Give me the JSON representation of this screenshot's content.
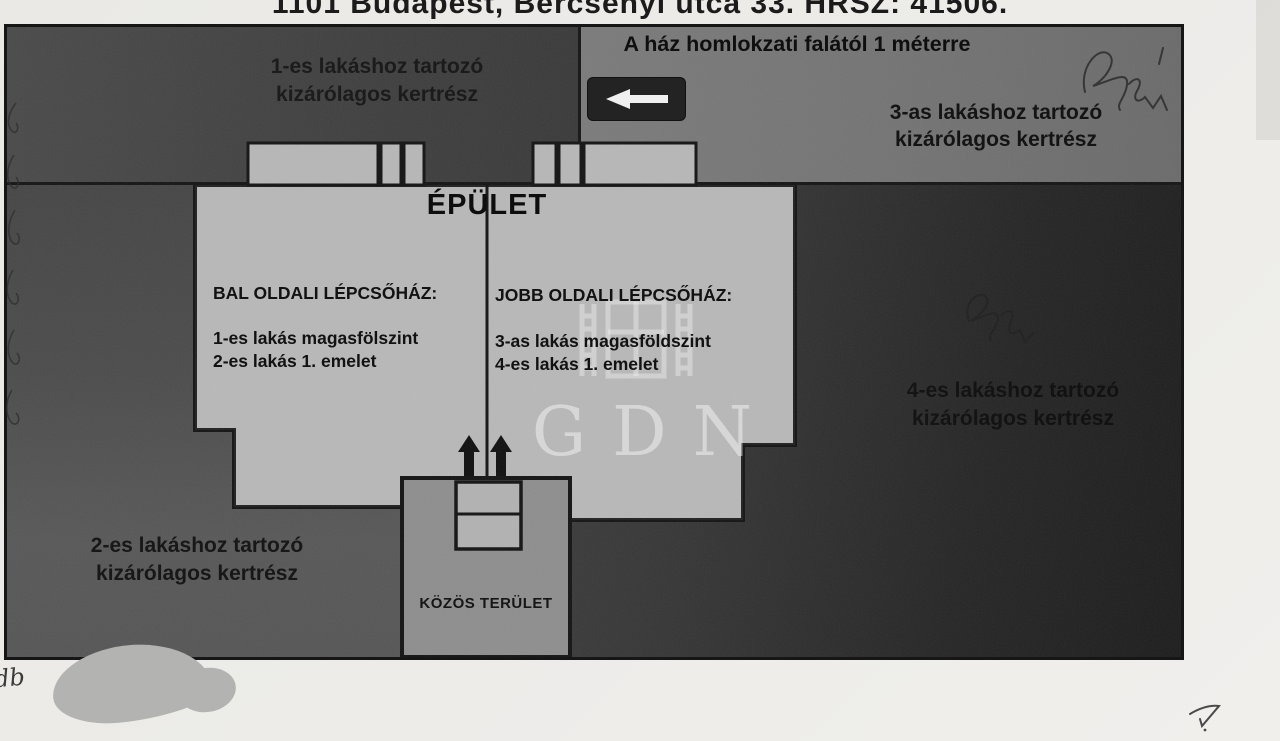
{
  "header": {
    "title": "1101 Budapest, Bercsényi utca 33. HRSZ: 41506."
  },
  "plan": {
    "garden1": {
      "line1": "1-es lakáshoz tartozó",
      "line2": "kizárólagos kertrész"
    },
    "garden2": {
      "line1": "2-es lakáshoz tartozó",
      "line2": "kizárólagos kertrész"
    },
    "garden3": {
      "line1": "3-as lakáshoz tartozó",
      "line2": "kizárólagos kertrész"
    },
    "garden4": {
      "line1": "4-es lakáshoz tartozó",
      "line2": "kizárólagos kertrész"
    },
    "facade_note": {
      "text": "A ház homlokzati falától 1 méterre"
    },
    "building": {
      "title": "ÉPÜLET",
      "left_stairwell": {
        "heading": "BAL OLDALI LÉPCSŐHÁZ:",
        "line1": "1-es lakás magasfölszint",
        "line2": "2-es lakás 1. emelet"
      },
      "right_stairwell": {
        "heading": "JOBB OLDALI LÉPCSŐHÁZ:",
        "line1": "3-as lakás magasföldszint",
        "line2": "4-es lakás 1. emelet"
      }
    },
    "common_area": {
      "label": "KÖZÖS TERÜLET"
    }
  },
  "watermark": {
    "text": "GDN"
  },
  "handwriting": {
    "corner_note": "db"
  },
  "icons": {
    "facade_arrow": "left-arrow-icon",
    "entrance_arrows": "up-arrow-icon"
  },
  "colors": {
    "paper": "#ecebe8",
    "garden_dark": "#2a2a2a",
    "garden_medium": "#565656",
    "strip_light": "#757575",
    "building": "#b5b5b5",
    "common_area": "#8e8e8e",
    "ink": "#141414",
    "watermark": "#e8e8e8"
  }
}
